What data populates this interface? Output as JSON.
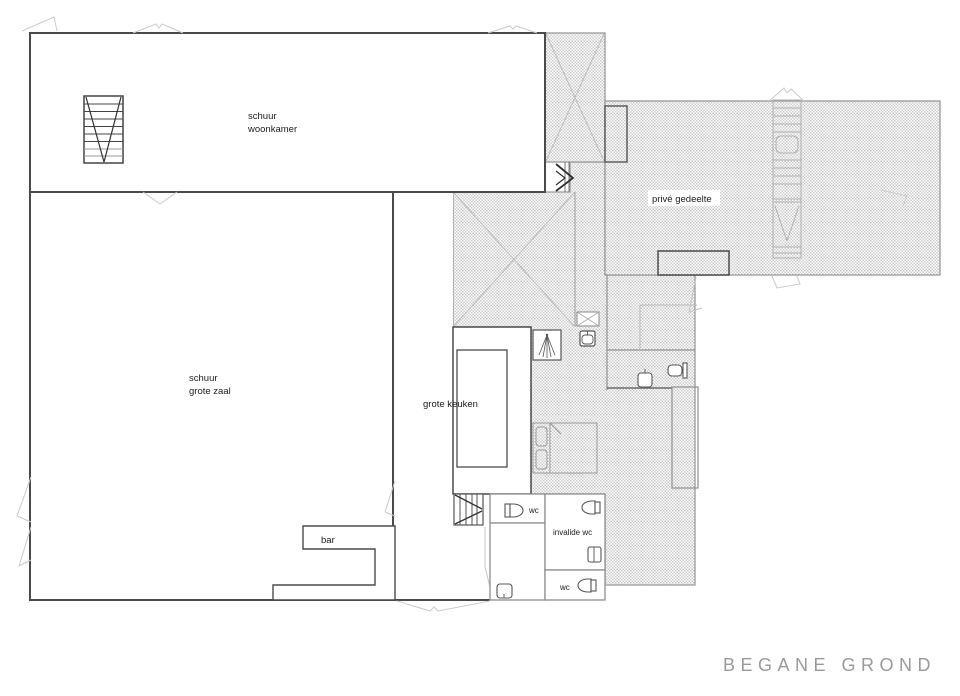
{
  "title": {
    "label": "BEGANE GROND",
    "color": "#9a9a9a"
  },
  "rooms": {
    "woonkamer": {
      "line1": "schuur",
      "line2": "woonkamer"
    },
    "grote_zaal": {
      "line1": "schuur",
      "line2": "grote zaal"
    },
    "grote_keuken": {
      "label": "grote keuken"
    },
    "prive_gedeelte": {
      "label": "privé gedeelte"
    },
    "bar": {
      "label": "bar"
    },
    "wc_1": {
      "label": "wc"
    },
    "invalide_wc": {
      "label": "invalide wc"
    },
    "wc_2": {
      "label": "wc"
    }
  },
  "colors": {
    "wall": "#4a4a4a",
    "room_outline": "#8f8f8f",
    "hatch_dot": "#cdcdcd",
    "hatch_outline": "#9a9a9a",
    "fixture": "#555555",
    "roof_line": "#c9c9c9",
    "title_text": "#9a9a9a"
  }
}
